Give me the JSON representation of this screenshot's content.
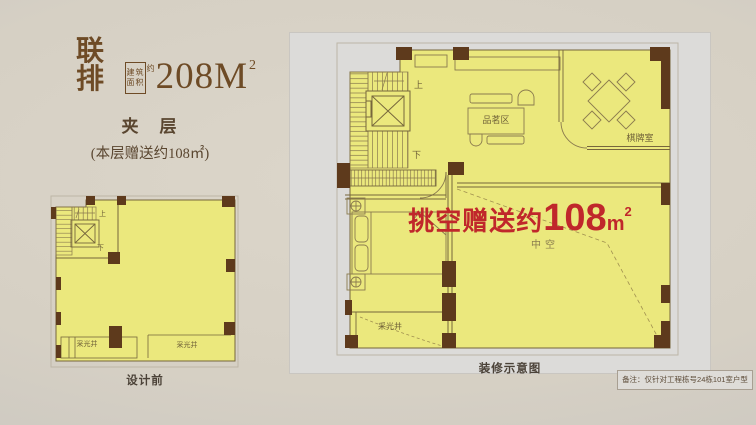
{
  "header": {
    "series": "联排",
    "area_box_line1": "建筑",
    "area_box_line2": "面积",
    "area_approx": "约",
    "area_value": "208M",
    "area_sup": "2",
    "floor_label": "夹　层",
    "bonus_label": "(本层赠送约108㎡)"
  },
  "left_plan": {
    "caption": "设计前",
    "up": "上",
    "down": "下",
    "lightwell_left": "采光井",
    "lightwell_right": "采光井"
  },
  "right_plan": {
    "caption": "装修示意图",
    "up": "上",
    "down": "下",
    "tea_area": "品茗区",
    "chess_room": "棋牌室",
    "void_prefix": "挑空赠送约",
    "void_number": "108",
    "void_unit": "m",
    "void_sup": "2",
    "hollow": "中空",
    "lightwell": "采光井",
    "note": "备注：仅针对工程栋号24栋101室户型"
  },
  "colors": {
    "background": "#d6d0c4",
    "panel_grey": "#dcdbd9",
    "floor_yellow": "#ebe87d",
    "wall_brown": "#5e3a1c",
    "line_brown": "#8a7a4e",
    "accent_red": "#c0272b",
    "title_brown": "#6e4b26"
  }
}
